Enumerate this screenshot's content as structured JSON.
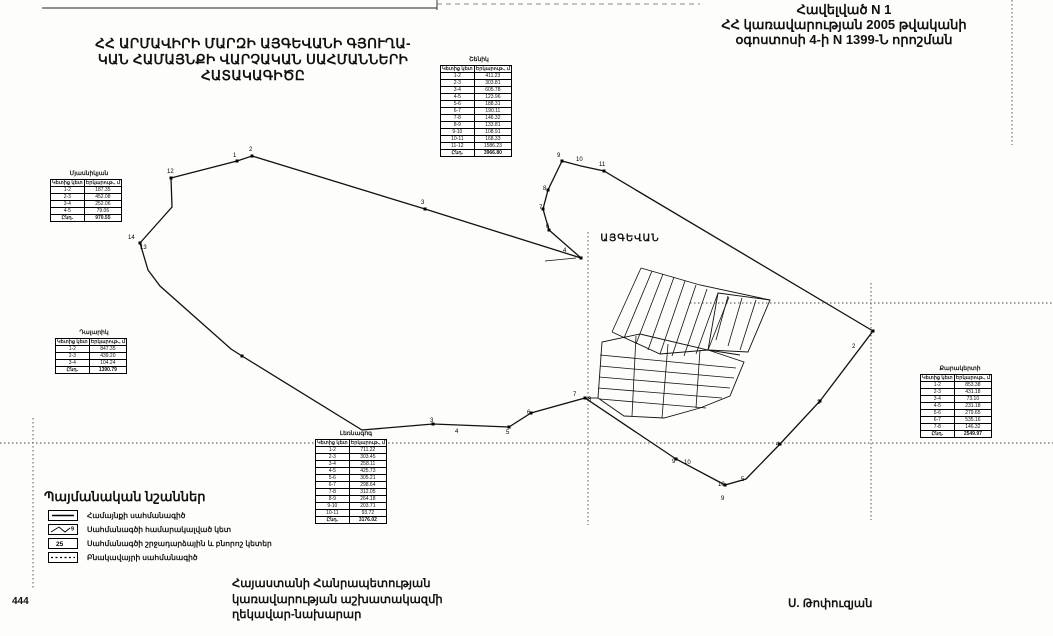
{
  "page": {
    "number": "444"
  },
  "annex": {
    "line1": "Հավելված N 1",
    "line2": "ՀՀ կառավարության 2005 թվականի",
    "line3": "օգոստոսի 4-ի N 1399-Ն որոշման"
  },
  "title": {
    "line1": "ՀՀ ԱՐՄԱՎԻՐԻ ՄԱՐԶԻ ԱՅԳԵՎԱՆԻ ԳՅՈՒՂԱ-",
    "line2": "ԿԱՆ ՀԱՄԱՅՆՔԻ ՎԱՐՉԱԿԱՆ ՍԱՀՄԱՆՆԵՐԻ",
    "line3": "ՀԱՏԱԿԱԳԻԾԸ"
  },
  "map": {
    "settlement_label": "ԱՅԳԵՎԱՆ",
    "shapes": [
      {
        "name": "frame-top",
        "points": "42,8 437,8",
        "stroke": "#222",
        "w": 0.9
      },
      {
        "name": "frame-notch",
        "points": "437,0 437,10",
        "stroke": "#222",
        "w": 0.9
      },
      {
        "name": "frame-top-right",
        "points": "437,4 700,4",
        "stroke": "#666",
        "w": 0.8,
        "dash": "5 4"
      },
      {
        "name": "fold-line-h1",
        "points": "0,443 1053,443",
        "stroke": "#444",
        "w": 0.9,
        "dash": "1.5 2.5"
      },
      {
        "name": "fold-line-h2",
        "points": "690,303 1053,303",
        "stroke": "#444",
        "w": 0.9,
        "dash": "1.5 2.5"
      },
      {
        "name": "fold-line-v1",
        "points": "588,232 588,525",
        "stroke": "#444",
        "w": 0.9,
        "dash": "1.5 2.5"
      },
      {
        "name": "fold-line-v2",
        "points": "871,283 871,520",
        "stroke": "#444",
        "w": 0.9,
        "dash": "1.5 2.5"
      },
      {
        "name": "fold-line-v3",
        "points": "1012,0 1012,145",
        "stroke": "#444",
        "w": 0.9,
        "dash": "1.5 2.5"
      },
      {
        "name": "fold-line-v4",
        "points": "33,418 33,590",
        "stroke": "#444",
        "w": 0.9,
        "dash": "1.5 2.5"
      },
      {
        "name": "community-boundary",
        "kind": "polygon",
        "points": "140,243 172,207 171,178 237,161 252,156 425,209 581,258 549,230 543,209 548,190 562,161 581,166 604,171 873,331 820,401 780,444 746,479 725,485 676,459 585,398 531,413 509,427 433,424 362,430 242,356 231,349 160,286 148,270",
        "stroke": "#111",
        "w": 1.3
      },
      {
        "name": "boundary-arrow",
        "points": "545,261 576,258",
        "stroke": "#111",
        "w": 0.8
      },
      {
        "name": "parcel-strip",
        "points": "612,332 641,268",
        "stroke": "#111",
        "w": 0.8
      },
      {
        "name": "parcel-strip",
        "points": "624,338 652,271",
        "stroke": "#111",
        "w": 0.8
      },
      {
        "name": "parcel-strip",
        "points": "636,344 663,274",
        "stroke": "#111",
        "w": 0.8
      },
      {
        "name": "parcel-strip",
        "points": "648,350 674,277",
        "stroke": "#111",
        "w": 0.8
      },
      {
        "name": "parcel-strip",
        "points": "660,354 685,281",
        "stroke": "#111",
        "w": 0.8
      },
      {
        "name": "parcel-strip",
        "points": "672,356 696,285",
        "stroke": "#111",
        "w": 0.8
      },
      {
        "name": "parcel-strip",
        "points": "684,356 707,289",
        "stroke": "#111",
        "w": 0.8
      },
      {
        "name": "parcel-strip",
        "points": "696,354 718,293",
        "stroke": "#111",
        "w": 0.8
      },
      {
        "name": "parcel-strip",
        "points": "708,350 729,297",
        "stroke": "#111",
        "w": 0.8
      },
      {
        "name": "parcel-top-edge",
        "points": "641,268 700,285 770,300",
        "stroke": "#111",
        "w": 0.9
      },
      {
        "name": "parcel-bottom-edge",
        "points": "612,332 660,354 708,350 740,355",
        "stroke": "#111",
        "w": 0.9
      },
      {
        "name": "parcel-block-east",
        "kind": "polygon",
        "points": "718,293 770,300 748,352 708,350",
        "stroke": "#111",
        "w": 0.9
      },
      {
        "name": "parcel-strip",
        "points": "728,296 716,340",
        "stroke": "#111",
        "w": 0.8
      },
      {
        "name": "parcel-strip",
        "points": "742,298 728,346",
        "stroke": "#111",
        "w": 0.8
      },
      {
        "name": "parcel-strip",
        "points": "756,300 740,350",
        "stroke": "#111",
        "w": 0.8
      },
      {
        "name": "parcel-block-south",
        "kind": "polygon",
        "points": "598,398 602,342 640,334 708,350 744,362 730,396 700,408 664,418 624,416",
        "stroke": "#111",
        "w": 0.9
      },
      {
        "name": "parcel-band",
        "points": "600,355 736,368",
        "stroke": "#111",
        "w": 0.8
      },
      {
        "name": "parcel-band",
        "points": "600,366 734,378",
        "stroke": "#111",
        "w": 0.8
      },
      {
        "name": "parcel-band",
        "points": "599,377 730,388",
        "stroke": "#111",
        "w": 0.8
      },
      {
        "name": "parcel-band",
        "points": "598,388 722,398",
        "stroke": "#111",
        "w": 0.8
      },
      {
        "name": "parcel-band",
        "points": "600,399 706,408",
        "stroke": "#111",
        "w": 0.8
      },
      {
        "name": "parcel-divider",
        "points": "636,336 632,416",
        "stroke": "#111",
        "w": 0.8
      },
      {
        "name": "parcel-divider",
        "points": "668,344 662,418",
        "stroke": "#111",
        "w": 0.8
      },
      {
        "name": "parcel-divider",
        "points": "700,350 696,408",
        "stroke": "#111",
        "w": 0.8
      },
      {
        "name": "parcel-connector",
        "points": "585,398 598,398",
        "stroke": "#111",
        "w": 0.9
      }
    ],
    "markers": [
      [
        171,
        178
      ],
      [
        237,
        161
      ],
      [
        252,
        156
      ],
      [
        425,
        209
      ],
      [
        581,
        258
      ],
      [
        562,
        161
      ],
      [
        604,
        171
      ],
      [
        873,
        331
      ],
      [
        820,
        401
      ],
      [
        780,
        444
      ],
      [
        725,
        485
      ],
      [
        585,
        398
      ],
      [
        509,
        427
      ],
      [
        433,
        424
      ],
      [
        242,
        356
      ],
      [
        140,
        243
      ],
      [
        676,
        459
      ],
      [
        531,
        413
      ],
      [
        548,
        190
      ],
      [
        543,
        209
      ],
      [
        549,
        230
      ]
    ],
    "labels": [
      {
        "x": 167,
        "y": 173,
        "t": "12"
      },
      {
        "x": 128,
        "y": 239,
        "t": "14"
      },
      {
        "x": 140,
        "y": 249,
        "t": "13"
      },
      {
        "x": 233,
        "y": 157,
        "t": "1"
      },
      {
        "x": 249,
        "y": 151,
        "t": "2"
      },
      {
        "x": 421,
        "y": 204,
        "t": "3"
      },
      {
        "x": 563,
        "y": 252,
        "t": "4"
      },
      {
        "x": 546,
        "y": 228,
        "t": "6"
      },
      {
        "x": 539,
        "y": 209,
        "t": "7"
      },
      {
        "x": 543,
        "y": 190,
        "t": "8"
      },
      {
        "x": 557,
        "y": 157,
        "t": "9"
      },
      {
        "x": 576,
        "y": 161,
        "t": "10"
      },
      {
        "x": 599,
        "y": 166,
        "t": "11"
      },
      {
        "x": 852,
        "y": 348,
        "t": "2"
      },
      {
        "x": 817,
        "y": 404,
        "t": "3"
      },
      {
        "x": 776,
        "y": 446,
        "t": "4"
      },
      {
        "x": 741,
        "y": 481,
        "t": "5"
      },
      {
        "x": 718,
        "y": 486,
        "t": "10"
      },
      {
        "x": 721,
        "y": 500,
        "t": "9"
      },
      {
        "x": 672,
        "y": 463,
        "t": "9"
      },
      {
        "x": 684,
        "y": 464,
        "t": "10"
      },
      {
        "x": 573,
        "y": 396,
        "t": "7"
      },
      {
        "x": 588,
        "y": 401,
        "t": "8"
      },
      {
        "x": 527,
        "y": 414,
        "t": "6"
      },
      {
        "x": 506,
        "y": 434,
        "t": "5"
      },
      {
        "x": 430,
        "y": 422,
        "t": "3"
      },
      {
        "x": 455,
        "y": 433,
        "t": "4"
      }
    ]
  },
  "tables": [
    {
      "title": "Շենիկ",
      "col1": "Կետից կետ",
      "col2": "Երկարութ., մ",
      "rows": [
        [
          "1-2",
          "411.23"
        ],
        [
          "2-3",
          "303.81"
        ],
        [
          "3-4",
          "605.78"
        ],
        [
          "4-5",
          "123.96"
        ],
        [
          "5-6",
          "188.31"
        ],
        [
          "6-7",
          "190.11"
        ],
        [
          "7-8",
          "146.32"
        ],
        [
          "8-9",
          "133.81"
        ],
        [
          "9-10",
          "108.91"
        ],
        [
          "10-11",
          "168.33"
        ],
        [
          "11-12",
          "1586.23"
        ]
      ],
      "total": [
        "Ընդ.",
        "3966.80"
      ]
    },
    {
      "title": "Մյասնիկյան",
      "col1": "Կետից կետ",
      "col2": "Երկարութ., մ",
      "rows": [
        [
          "1-2",
          "187.35"
        ],
        [
          "2-3",
          "452.08"
        ],
        [
          "3-4",
          "252.06"
        ],
        [
          "4-5",
          "79.06"
        ]
      ],
      "total": [
        "Ընդ.",
        "970.55"
      ]
    },
    {
      "title": "Դալարիկ",
      "col1": "Կետից կետ",
      "col2": "Երկարութ., մ",
      "rows": [
        [
          "1-2",
          "847.35"
        ],
        [
          "2-3",
          "439.20"
        ],
        [
          "3-4",
          "104.24"
        ]
      ],
      "total": [
        "Ընդ.",
        "1390.79"
      ]
    },
    {
      "title": "Լեռնագոգ",
      "col1": "Կետից կետ",
      "col2": "Երկարութ., մ",
      "rows": [
        [
          "1-2",
          "711.22"
        ],
        [
          "2-3",
          "303.45"
        ],
        [
          "3-4",
          "258.11"
        ],
        [
          "4-5",
          "425.73"
        ],
        [
          "5-6",
          "305.21"
        ],
        [
          "6-7",
          "298.64"
        ],
        [
          "7-8",
          "312.05"
        ],
        [
          "8-9",
          "264.18"
        ],
        [
          "9-10",
          "203.71"
        ],
        [
          "10-11",
          "93.72"
        ]
      ],
      "total": [
        "Ընդ.",
        "3176.02"
      ]
    },
    {
      "title": "Քարակերտի",
      "col1": "Կետից կետ",
      "col2": "Երկարութ., մ",
      "rows": [
        [
          "1-2",
          "853.38"
        ],
        [
          "2-3",
          "431.18"
        ],
        [
          "3-4",
          "73.10"
        ],
        [
          "4-5",
          "231.18"
        ],
        [
          "5-6",
          "279.65"
        ],
        [
          "6-7",
          "535.16"
        ],
        [
          "7-8",
          "146.32"
        ]
      ],
      "total": [
        "Ընդ.",
        "2549.97"
      ]
    }
  ],
  "legend": {
    "title": "Պայմանական նշաններ",
    "items": [
      {
        "symbol": "solid-line",
        "label": "Համայնքի սահմանագիծ"
      },
      {
        "symbol": "numbered-point",
        "label": "Սահմանագծի համարակալված կետ",
        "sample": "9"
      },
      {
        "symbol": "turn-point",
        "label": "Սահմանագծի շրջադարձային և բնորոշ կետեր",
        "sample": "25"
      },
      {
        "symbol": "dotted-line",
        "label": "Բնակավայրի սահմանագիծ"
      }
    ]
  },
  "footer": {
    "left_line1": "Հայաստանի Հանրապետության",
    "left_line2": "կառավարության աշխատակազմի",
    "left_line3": "ղեկավար-նախարար",
    "signature": "Ս. Թոփուզյան"
  },
  "colors": {
    "ink": "#111111",
    "paper": "#fdfdfb"
  }
}
